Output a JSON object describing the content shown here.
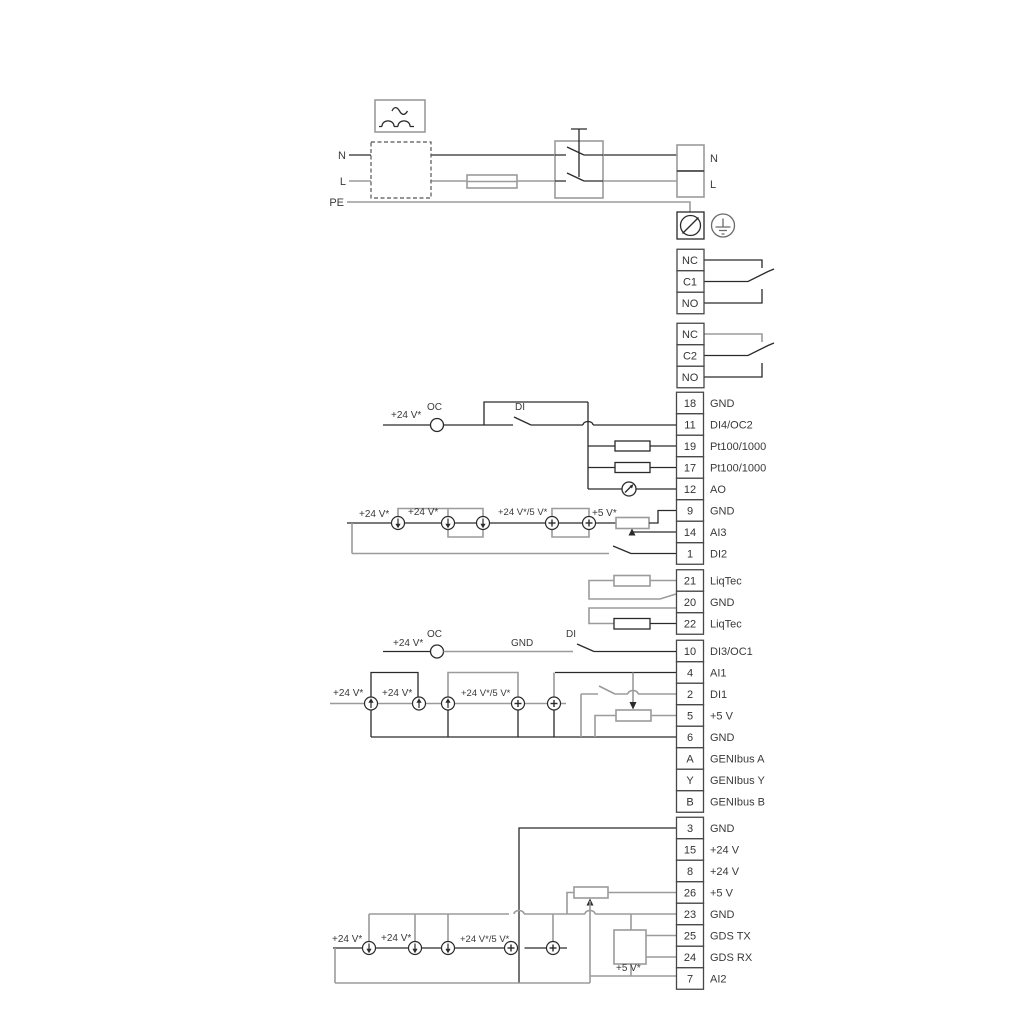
{
  "power": {
    "left_n": "N",
    "left_l": "L",
    "left_pe": "PE",
    "right_n": "N",
    "right_l": "L"
  },
  "relay1": {
    "terminals": [
      "NC",
      "C1",
      "NO"
    ]
  },
  "relay2": {
    "terminals": [
      "NC",
      "C2",
      "NO"
    ]
  },
  "groupA": [
    {
      "id": "18",
      "label": "GND"
    },
    {
      "id": "11",
      "label": "DI4/OC2"
    },
    {
      "id": "19",
      "label": "Pt100/1000"
    },
    {
      "id": "17",
      "label": "Pt100/1000"
    },
    {
      "id": "12",
      "label": "AO"
    },
    {
      "id": "9",
      "label": "GND"
    },
    {
      "id": "14",
      "label": "AI3"
    },
    {
      "id": "1",
      "label": "DI2"
    }
  ],
  "groupB": [
    {
      "id": "21",
      "label": "LiqTec"
    },
    {
      "id": "20",
      "label": "GND"
    },
    {
      "id": "22",
      "label": "LiqTec"
    }
  ],
  "groupC": [
    {
      "id": "10",
      "label": "DI3/OC1"
    },
    {
      "id": "4",
      "label": "AI1"
    },
    {
      "id": "2",
      "label": "DI1"
    },
    {
      "id": "5",
      "label": "+5 V"
    },
    {
      "id": "6",
      "label": "GND"
    },
    {
      "id": "A",
      "label": "GENIbus A"
    },
    {
      "id": "Y",
      "label": "GENIbus Y"
    },
    {
      "id": "B",
      "label": "GENIbus B"
    }
  ],
  "groupD": [
    {
      "id": "3",
      "label": "GND"
    },
    {
      "id": "15",
      "label": "+24 V"
    },
    {
      "id": "8",
      "label": "+24 V"
    },
    {
      "id": "26",
      "label": "+5 V"
    },
    {
      "id": "23",
      "label": "GND"
    },
    {
      "id": "25",
      "label": "GDS TX"
    },
    {
      "id": "24",
      "label": "GDS RX"
    },
    {
      "id": "7",
      "label": "AI2"
    }
  ],
  "labels": {
    "v24": "+24 V*",
    "v24_5": "+24 V*/5 V*",
    "v5": "+5 V*",
    "oc": "OC",
    "di": "DI",
    "gnd": "GND"
  },
  "colors": {
    "wire_dark": "#2a2a2a",
    "wire_gray": "#9b9b9b",
    "text": "#3a3a3a",
    "terminal_border": "#474747",
    "background": "#ffffff"
  }
}
